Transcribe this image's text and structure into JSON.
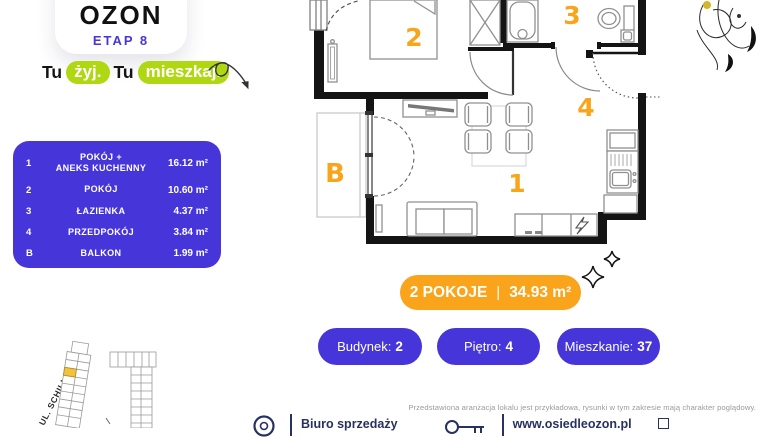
{
  "brand": {
    "logo": "OZON",
    "stage": "ETAP 8",
    "tagline": {
      "word1": "Tu",
      "highlight1": "żyj.",
      "word2": "Tu",
      "highlight2": "mieszkaj."
    }
  },
  "colors": {
    "purple": "#4636d9",
    "orange": "#f9a41b",
    "green": "#afd712",
    "navy": "#27325f"
  },
  "rooms_table": {
    "rows": [
      {
        "num": "1",
        "name": "POKÓJ +",
        "name2": "ANEKS KUCHENNY",
        "area": "16.12 m²"
      },
      {
        "num": "2",
        "name": "POKÓJ",
        "name2": "",
        "area": "10.60 m²"
      },
      {
        "num": "3",
        "name": "ŁAZIENKA",
        "name2": "",
        "area": "4.37 m²"
      },
      {
        "num": "4",
        "name": "PRZEDPOKÓJ",
        "name2": "",
        "area": "3.84 m²"
      },
      {
        "num": "B",
        "name": "BALKON",
        "name2": "",
        "area": "1.99 m²"
      }
    ]
  },
  "plan": {
    "labels": {
      "room1": "1",
      "room2": "2",
      "room3": "3",
      "room4": "4",
      "balcony": "B"
    }
  },
  "summary": {
    "badge": {
      "rooms": "2 POKOJE",
      "sep": "|",
      "area": "34.93 m²"
    },
    "pills": [
      {
        "label": "Budynek:",
        "value": "2"
      },
      {
        "label": "Piętro:",
        "value": "4"
      },
      {
        "label": "Mieszkanie:",
        "value": "37"
      }
    ]
  },
  "map": {
    "street": "UL. SCHILLINGA"
  },
  "footer": {
    "disclaimer": "Przedstawiona aranżacja lokalu jest przykładowa, rysunki w tym zakresie mają charakter poglądowy.",
    "office": "Biuro sprzedaży",
    "website": "www.osiedleozon.pl"
  }
}
